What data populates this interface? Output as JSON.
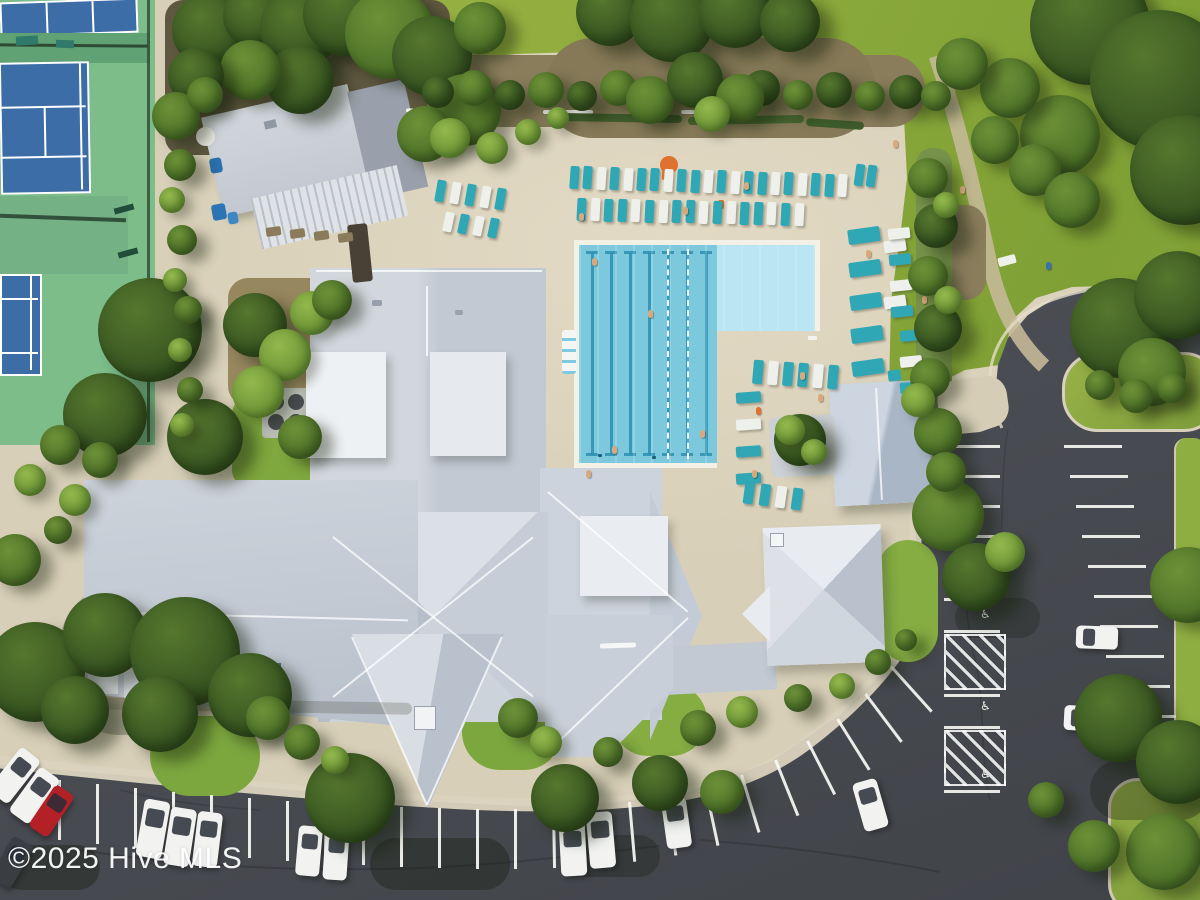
{
  "watermark": {
    "text": "©2025 Hive MLS"
  },
  "palette": {
    "deck": "#d8cfb8",
    "lawn": "#8fac3d",
    "asphalt": "#4b4e54",
    "court_green": "#7cbd8a",
    "court_blue": "#3c6da6",
    "roof_gray": "#c6ccd6",
    "roof_white": "#eef1f4",
    "pool_deep": "#7cc9de",
    "pool_shallow": "#b9e6f2",
    "lane_line": "#2c8fb2",
    "lounger_teal": "#2fa7b4",
    "lounger_white": "#eef0eb",
    "car_white": "#f2f3f1",
    "car_red": "#b32025",
    "car_dark": "#3a3d42",
    "stripe_white": "#faf9f5"
  },
  "parking": {
    "handicap_glyph": "♿"
  },
  "pool_lanes": {
    "count": 7,
    "rel_xs": [
      12,
      31,
      50,
      69,
      88,
      107,
      126
    ],
    "rope_rel_xs": [
      88,
      108
    ]
  },
  "lounger_rows": [
    {
      "x": 570,
      "y": 166,
      "dx": 13.4,
      "dy": 0.4,
      "n": 21,
      "w": 9,
      "h": 23,
      "rot": 4,
      "pat": "TTWTWTTWTTWTWTTWTWTTW"
    },
    {
      "x": 577,
      "y": 198,
      "dx": 13.6,
      "dy": 0.3,
      "n": 17,
      "w": 9,
      "h": 23,
      "rot": 3,
      "pat": "TWTTWTWTTWTWTTWTW"
    },
    {
      "x": 436,
      "y": 180,
      "dx": 15,
      "dy": 2,
      "n": 5,
      "w": 9,
      "h": 22,
      "rot": 10,
      "pat": "TWTWT"
    },
    {
      "x": 444,
      "y": 212,
      "dx": 15,
      "dy": 2,
      "n": 4,
      "w": 9,
      "h": 20,
      "rot": 12,
      "pat": "WTWT"
    },
    {
      "x": 848,
      "y": 228,
      "dx": 1,
      "dy": 33,
      "n": 5,
      "w": 32,
      "h": 15,
      "rot": -8,
      "pat": "TTTTT"
    },
    {
      "x": 884,
      "y": 240,
      "dx": 0,
      "dy": 56,
      "n": 2,
      "w": 22,
      "h": 12,
      "rot": -8,
      "pat": "WW"
    },
    {
      "x": 888,
      "y": 228,
      "dx": 1,
      "dy": 26,
      "n": 4,
      "w": 22,
      "h": 11,
      "rot": -6,
      "pat": "WTWT"
    },
    {
      "x": 900,
      "y": 330,
      "dx": 0,
      "dy": 26,
      "n": 3,
      "w": 22,
      "h": 11,
      "rot": -6,
      "pat": "TWT"
    },
    {
      "x": 753,
      "y": 360,
      "dx": 15,
      "dy": 1,
      "n": 6,
      "w": 10,
      "h": 24,
      "rot": 5,
      "pat": "TWTTWT"
    },
    {
      "x": 736,
      "y": 392,
      "dx": 0,
      "dy": 27,
      "n": 4,
      "w": 25,
      "h": 11,
      "rot": -4,
      "pat": "TWTT"
    },
    {
      "x": 744,
      "y": 482,
      "dx": 16,
      "dy": 2,
      "n": 4,
      "w": 10,
      "h": 22,
      "rot": 8,
      "pat": "TTWT"
    },
    {
      "x": 855,
      "y": 164,
      "dx": 12,
      "dy": 1,
      "n": 2,
      "w": 9,
      "h": 22,
      "rot": 8,
      "pat": "TT"
    }
  ],
  "bottom_stripes": [
    [
      58,
      780,
      0
    ],
    [
      96,
      784,
      0
    ],
    [
      134,
      788,
      0
    ],
    [
      172,
      792,
      0
    ],
    [
      210,
      795,
      0
    ],
    [
      248,
      798,
      0
    ],
    [
      286,
      801,
      0
    ],
    [
      324,
      803,
      0
    ],
    [
      362,
      805,
      0
    ],
    [
      400,
      807,
      0
    ],
    [
      438,
      808,
      0
    ],
    [
      476,
      809,
      0
    ],
    [
      514,
      809,
      0
    ],
    [
      552,
      808,
      -1
    ],
    [
      590,
      806,
      -2
    ],
    [
      628,
      802,
      -5
    ],
    [
      666,
      796,
      -8
    ],
    [
      704,
      787,
      -12
    ],
    [
      740,
      775,
      -17
    ],
    [
      774,
      760,
      -22
    ],
    [
      806,
      741,
      -27
    ],
    [
      836,
      719,
      -32
    ],
    [
      864,
      694,
      -37
    ],
    [
      890,
      667,
      -42
    ]
  ],
  "right_lot": {
    "left_col": {
      "x": 944,
      "w": 56,
      "ys": [
        445,
        475,
        505,
        535,
        565,
        598,
        630,
        694,
        726,
        790
      ]
    },
    "right_col": {
      "x0": 1064,
      "slope": 0.2,
      "w": 58,
      "ys": [
        445,
        475,
        505,
        535,
        565,
        595,
        625,
        655,
        685,
        715,
        745
      ]
    },
    "hatches": [
      [
        944,
        634,
        58,
        52
      ],
      [
        944,
        730,
        58,
        52
      ]
    ],
    "wheelchairs": [
      [
        980,
        608
      ],
      [
        980,
        700
      ],
      [
        980,
        768
      ]
    ]
  },
  "cars": [
    [
      2,
      748,
      25,
      55,
      38,
      "white"
    ],
    [
      22,
      768,
      25,
      55,
      36,
      "white"
    ],
    [
      40,
      786,
      23,
      50,
      34,
      "red"
    ],
    [
      0,
      838,
      24,
      48,
      30,
      "dark"
    ],
    [
      140,
      800,
      26,
      58,
      10,
      "white"
    ],
    [
      167,
      808,
      26,
      58,
      9,
      "white"
    ],
    [
      195,
      812,
      25,
      55,
      7,
      "white"
    ],
    [
      297,
      826,
      24,
      50,
      5,
      "white"
    ],
    [
      324,
      830,
      24,
      50,
      4,
      "white"
    ],
    [
      560,
      822,
      26,
      54,
      -3,
      "white"
    ],
    [
      588,
      812,
      26,
      56,
      -5,
      "white"
    ],
    [
      664,
      798,
      25,
      50,
      -8,
      "white"
    ],
    [
      858,
      780,
      25,
      50,
      -16,
      "white"
    ],
    [
      1076,
      626,
      42,
      23,
      2,
      "white"
    ],
    [
      1064,
      706,
      46,
      25,
      3,
      "white"
    ],
    [
      1152,
      738,
      46,
      28,
      6,
      "red"
    ]
  ],
  "people": [
    [
      592,
      258
    ],
    [
      648,
      310
    ],
    [
      700,
      430
    ],
    [
      612,
      446
    ],
    [
      586,
      470
    ],
    [
      756,
      407,
      "#e0712f"
    ],
    [
      800,
      372
    ],
    [
      922,
      296
    ],
    [
      940,
      465
    ],
    [
      866,
      250
    ],
    [
      744,
      182
    ],
    [
      683,
      207
    ],
    [
      579,
      213
    ],
    [
      1046,
      262,
      "#3a6fb0"
    ],
    [
      960,
      186
    ],
    [
      893,
      140
    ],
    [
      818,
      394
    ],
    [
      752,
      470
    ]
  ],
  "trees": [
    [
      210,
      30,
      38,
      "dark"
    ],
    [
      255,
      16,
      32,
      "dark"
    ],
    [
      300,
      28,
      40,
      "dark"
    ],
    [
      345,
      14,
      42,
      "dark"
    ],
    [
      390,
      34,
      45,
      "mid"
    ],
    [
      432,
      56,
      40,
      "dark"
    ],
    [
      465,
      110,
      36,
      "mid"
    ],
    [
      425,
      134,
      28,
      "mid"
    ],
    [
      300,
      80,
      34,
      "dark"
    ],
    [
      250,
      70,
      30,
      "mid"
    ],
    [
      196,
      76,
      28,
      "dark"
    ],
    [
      176,
      116,
      24,
      "mid"
    ],
    [
      480,
      28,
      26,
      "mid"
    ],
    [
      610,
      12,
      34,
      "dark"
    ],
    [
      672,
      20,
      42,
      "dark"
    ],
    [
      735,
      12,
      36,
      "dark"
    ],
    [
      790,
      22,
      30,
      "dark"
    ],
    [
      1090,
      25,
      60,
      "dark"
    ],
    [
      1160,
      80,
      70,
      "dark"
    ],
    [
      1185,
      170,
      55,
      "dark"
    ],
    [
      1060,
      135,
      40,
      "mid"
    ],
    [
      1010,
      88,
      30,
      "mid"
    ],
    [
      962,
      64,
      26,
      "mid"
    ],
    [
      995,
      140,
      24,
      "mid"
    ],
    [
      1035,
      170,
      26,
      "mid"
    ],
    [
      1072,
      200,
      28,
      "mid"
    ],
    [
      1120,
      328,
      50,
      "dark"
    ],
    [
      1178,
      295,
      44,
      "dark"
    ],
    [
      1152,
      372,
      34,
      "mid"
    ],
    [
      1100,
      385,
      15,
      "mid"
    ],
    [
      1136,
      396,
      17,
      "mid"
    ],
    [
      1172,
      388,
      15,
      "mid"
    ],
    [
      1188,
      585,
      38,
      "mid"
    ],
    [
      948,
      515,
      36,
      "mid"
    ],
    [
      976,
      577,
      34,
      "dark"
    ],
    [
      1005,
      552,
      20,
      "light"
    ],
    [
      1118,
      718,
      44,
      "dark"
    ],
    [
      1178,
      762,
      42,
      "dark"
    ],
    [
      1164,
      852,
      38,
      "mid"
    ],
    [
      1094,
      846,
      26,
      "mid"
    ],
    [
      1046,
      800,
      18,
      "mid"
    ],
    [
      565,
      798,
      34,
      "dark"
    ],
    [
      660,
      783,
      28,
      "dark"
    ],
    [
      722,
      792,
      22,
      "mid"
    ],
    [
      350,
      798,
      45,
      "dark"
    ],
    [
      35,
      672,
      50,
      "dark"
    ],
    [
      105,
      635,
      42,
      "dark"
    ],
    [
      185,
      652,
      55,
      "dark"
    ],
    [
      250,
      695,
      42,
      "dark"
    ],
    [
      160,
      714,
      38,
      "dark"
    ],
    [
      75,
      710,
      34,
      "dark"
    ],
    [
      15,
      560,
      26,
      "mid"
    ],
    [
      150,
      330,
      52,
      "dark"
    ],
    [
      105,
      415,
      42,
      "dark"
    ],
    [
      205,
      437,
      38,
      "dark"
    ],
    [
      255,
      325,
      32,
      "dark"
    ],
    [
      285,
      355,
      26,
      "light"
    ],
    [
      312,
      313,
      22,
      "light"
    ],
    [
      258,
      392,
      26,
      "light"
    ],
    [
      300,
      437,
      22,
      "mid"
    ],
    [
      332,
      300,
      20,
      "mid"
    ],
    [
      268,
      718,
      22,
      "mid"
    ],
    [
      302,
      742,
      18,
      "mid"
    ],
    [
      335,
      760,
      14,
      "light"
    ],
    [
      518,
      718,
      20,
      "mid"
    ],
    [
      546,
      742,
      16,
      "light"
    ],
    [
      608,
      752,
      15,
      "mid"
    ],
    [
      698,
      728,
      18,
      "mid"
    ],
    [
      742,
      712,
      16,
      "light"
    ],
    [
      798,
      698,
      14,
      "mid"
    ],
    [
      842,
      686,
      13,
      "light"
    ],
    [
      878,
      662,
      13,
      "mid"
    ],
    [
      906,
      640,
      11,
      "mid"
    ],
    [
      928,
      178,
      20,
      "mid"
    ],
    [
      936,
      226,
      22,
      "dark"
    ],
    [
      928,
      276,
      20,
      "mid"
    ],
    [
      938,
      328,
      24,
      "dark"
    ],
    [
      930,
      378,
      20,
      "mid"
    ],
    [
      948,
      300,
      14,
      "light"
    ],
    [
      946,
      205,
      13,
      "light"
    ],
    [
      938,
      432,
      24,
      "mid"
    ],
    [
      918,
      400,
      17,
      "light"
    ],
    [
      946,
      472,
      20,
      "mid"
    ],
    [
      180,
      165,
      16,
      "mid"
    ],
    [
      172,
      200,
      13,
      "light"
    ],
    [
      182,
      240,
      15,
      "mid"
    ],
    [
      175,
      280,
      12,
      "light"
    ],
    [
      188,
      310,
      14,
      "mid"
    ],
    [
      180,
      350,
      12,
      "light"
    ],
    [
      190,
      390,
      13,
      "mid"
    ],
    [
      182,
      425,
      12,
      "light"
    ],
    [
      205,
      95,
      18,
      "mid"
    ],
    [
      60,
      445,
      20,
      "mid"
    ],
    [
      100,
      460,
      18,
      "mid"
    ],
    [
      30,
      480,
      16,
      "light"
    ],
    [
      75,
      500,
      16,
      "light"
    ],
    [
      58,
      530,
      14,
      "mid"
    ],
    [
      438,
      92,
      16,
      "dark"
    ],
    [
      474,
      88,
      18,
      "mid"
    ],
    [
      510,
      95,
      15,
      "dark"
    ],
    [
      546,
      90,
      18,
      "mid"
    ],
    [
      582,
      96,
      15,
      "dark"
    ],
    [
      618,
      88,
      18,
      "mid"
    ],
    [
      654,
      95,
      16,
      "dark"
    ],
    [
      690,
      83,
      20,
      "dark"
    ],
    [
      726,
      94,
      16,
      "mid"
    ],
    [
      762,
      88,
      18,
      "dark"
    ],
    [
      798,
      95,
      15,
      "mid"
    ],
    [
      834,
      90,
      18,
      "dark"
    ],
    [
      870,
      96,
      15,
      "mid"
    ],
    [
      906,
      92,
      17,
      "dark"
    ],
    [
      936,
      96,
      15,
      "mid"
    ],
    [
      650,
      100,
      24,
      "mid"
    ],
    [
      695,
      80,
      28,
      "dark"
    ],
    [
      740,
      98,
      24,
      "mid"
    ],
    [
      712,
      114,
      18,
      "light"
    ],
    [
      450,
      138,
      20,
      "light"
    ],
    [
      492,
      148,
      16,
      "light"
    ],
    [
      528,
      132,
      13,
      "light"
    ],
    [
      558,
      118,
      11,
      "light"
    ],
    [
      800,
      440,
      26,
      "dark"
    ],
    [
      790,
      430,
      15,
      "light"
    ],
    [
      814,
      452,
      13,
      "light"
    ]
  ],
  "ground_rects": [
    [
      "soil-top",
      165,
      0,
      285,
      155,
      "#5f5840",
      18,
      0
    ],
    [
      "garden-mulch",
      228,
      278,
      108,
      128,
      "#96875f",
      20,
      0
    ],
    [
      "garden-grass",
      232,
      396,
      100,
      92,
      "#7fa83e",
      18,
      0
    ],
    [
      "south-lawn-1",
      150,
      716,
      110,
      80,
      "#7ca73f",
      40,
      0
    ],
    [
      "south-lawn-2",
      462,
      694,
      100,
      76,
      "#7ca73f",
      40,
      0
    ],
    [
      "south-lawn-3",
      612,
      684,
      95,
      72,
      "#85ad42",
      40,
      0
    ],
    [
      "south-lawn-4",
      878,
      540,
      60,
      122,
      "#85ad42",
      30,
      0
    ],
    [
      "mulch-right",
      936,
      205,
      50,
      95,
      "#8a7d5c",
      20,
      0
    ],
    [
      "deck-hedge-bed",
      916,
      148,
      36,
      262,
      "#77934b",
      16,
      0
    ],
    [
      "walk-blob",
      938,
      378,
      70,
      52,
      "#d5cdb6",
      20,
      -8
    ],
    [
      "mulch-band",
      425,
      55,
      500,
      72,
      "#8a7d5c",
      34,
      0
    ],
    [
      "mulch-bulge",
      545,
      38,
      330,
      100,
      "#857957",
      48,
      0
    ],
    [
      "shadow-bl",
      60,
      585,
      130,
      150,
      "rgba(30,40,20,.28)",
      60,
      0
    ],
    [
      "shadow-parking-1",
      370,
      838,
      140,
      52,
      "rgba(25,30,18,.4)",
      50,
      0
    ],
    [
      "shadow-parking-2",
      560,
      835,
      100,
      42,
      "rgba(25,30,18,.33)",
      50,
      0
    ],
    [
      "shadow-parking-3",
      0,
      845,
      100,
      45,
      "rgba(25,30,18,.4)",
      50,
      0
    ],
    [
      "shadow-parking-4",
      1090,
      760,
      120,
      60,
      "rgba(25,30,18,.33)",
      50,
      0
    ],
    [
      "shadow-parking-5",
      955,
      598,
      85,
      40,
      "rgba(25,30,18,.28)",
      50,
      0
    ],
    [
      "ac-pad",
      262,
      388,
      52,
      50,
      "#b8bcb4",
      4,
      0
    ],
    [
      "ac-fan",
      268,
      394,
      16,
      16,
      "#474b4e",
      99,
      0
    ],
    [
      "ac-fan",
      288,
      394,
      16,
      16,
      "#474b4e",
      99,
      0
    ],
    [
      "ac-fan",
      268,
      414,
      16,
      16,
      "#474b4e",
      99,
      0
    ],
    [
      "ac-fan",
      288,
      414,
      16,
      16,
      "#474b4e",
      99,
      0
    ]
  ],
  "deck_rects": [
    [
      "white-fence",
      406,
      110,
      94,
      4,
      "#f4f4ee",
      2,
      2
    ],
    [
      "white-fence",
      543,
      110,
      50,
      4,
      "#f4f4ee",
      2,
      0
    ],
    [
      "white-fence",
      681,
      110,
      22,
      4,
      "#f4f4ee",
      2,
      0
    ],
    [
      "white-fence",
      820,
      122,
      28,
      4,
      "#f0f0e8",
      2,
      8
    ],
    [
      "hedge-line",
      556,
      114,
      126,
      8,
      "#3f5c2c",
      4,
      1
    ],
    [
      "hedge-line",
      688,
      116,
      116,
      8,
      "#44622e",
      4,
      -1
    ],
    [
      "hedge-line",
      806,
      120,
      58,
      8,
      "#3f5c2c",
      4,
      4
    ],
    [
      "blue-bin",
      210,
      158,
      12,
      15,
      "#2b6fae",
      3,
      -10
    ],
    [
      "blue-bin",
      212,
      204,
      14,
      16,
      "#2d74b5",
      3,
      -10
    ],
    [
      "blue-bin",
      228,
      212,
      10,
      12,
      "#3f86c4",
      3,
      -10
    ],
    [
      "umbrella-orange",
      660,
      156,
      18,
      18,
      "#e0712f",
      99,
      0
    ],
    [
      "umbrella-white",
      196,
      127,
      19,
      19,
      "#eceae2",
      99,
      0
    ],
    [
      "trellis",
      350,
      224,
      20,
      58,
      "#4a4136",
      3,
      -6
    ],
    [
      "picnic-table",
      266,
      227,
      15,
      9,
      "#8a7c5b",
      2,
      -8
    ],
    [
      "picnic-table",
      290,
      229,
      15,
      9,
      "#8a7c5b",
      2,
      -8
    ],
    [
      "picnic-table",
      314,
      231,
      15,
      9,
      "#8a7c5b",
      2,
      -8
    ],
    [
      "picnic-table",
      338,
      233,
      15,
      9,
      "#8a7c5b",
      2,
      -8
    ],
    [
      "palm-planter",
      770,
      416,
      66,
      60,
      "#ccd1d5",
      6,
      -3
    ],
    [
      "pool-drain",
      598,
      454,
      4,
      3,
      "#1d607a",
      1,
      0
    ],
    [
      "pool-drain",
      652,
      456,
      4,
      3,
      "#1d607a",
      1,
      0
    ],
    [
      "pool-ladder",
      808,
      336,
      9,
      4,
      "#f2f2ee",
      1,
      0
    ],
    [
      "lawn-chair",
      998,
      256,
      18,
      9,
      "#eef0ea",
      2,
      -15
    ],
    [
      "teal-chair",
      888,
      370,
      13,
      11,
      "#2fa7b4",
      2,
      -8
    ],
    [
      "towel",
      662,
      170,
      6,
      10,
      "#e0712f",
      2,
      4
    ],
    [
      "towel",
      718,
      200,
      6,
      9,
      "#d96a2a",
      2,
      3
    ],
    [
      "road-marking",
      1096,
      298,
      13,
      5,
      "#e8e6dd",
      1,
      -28
    ],
    [
      "building-shadow",
      92,
      700,
      320,
      12,
      "rgba(70,70,55,.25)",
      8,
      1
    ],
    [
      "building-shadow",
      930,
      392,
      10,
      108,
      "rgba(70,70,55,.28)",
      6,
      -3
    ]
  ]
}
